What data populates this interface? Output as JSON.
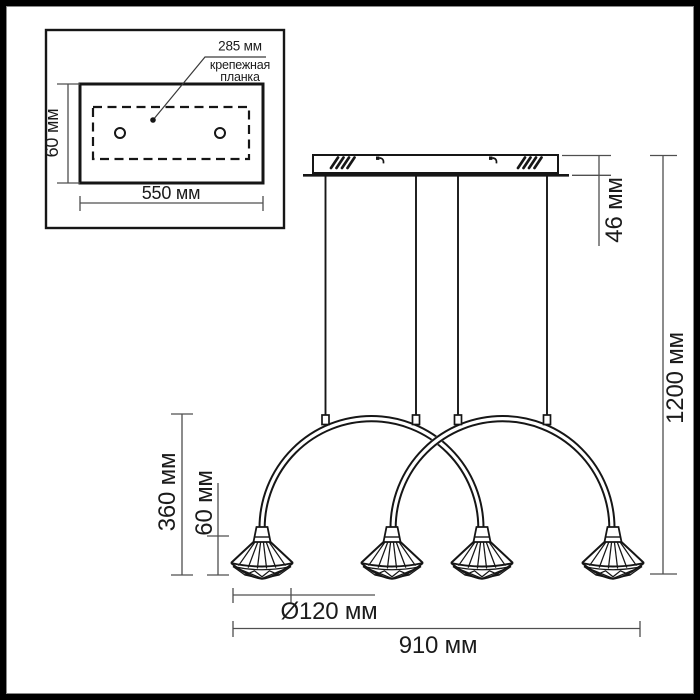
{
  "colors": {
    "background": "#ffffff",
    "ink": "#161616",
    "dim_line": "#4f4f4f",
    "frame": "#000000"
  },
  "inset": {
    "plate_width_label": "285 мм",
    "plate_name_line1": "крепежная",
    "plate_name_line2": "планка",
    "plate_height_label": "60 мм",
    "plate_length_label": "550 мм",
    "hole_count": 2
  },
  "dimensions": {
    "canopy_height": "46 мм",
    "overall_height": "1200 мм",
    "arc_drop": "360 мм",
    "shade_height": "60 мм",
    "shade_diameter": "Ø120 мм",
    "overall_width": "910 мм"
  },
  "fixture": {
    "cable_count": 4,
    "shade_count": 4,
    "arc_count": 2
  }
}
